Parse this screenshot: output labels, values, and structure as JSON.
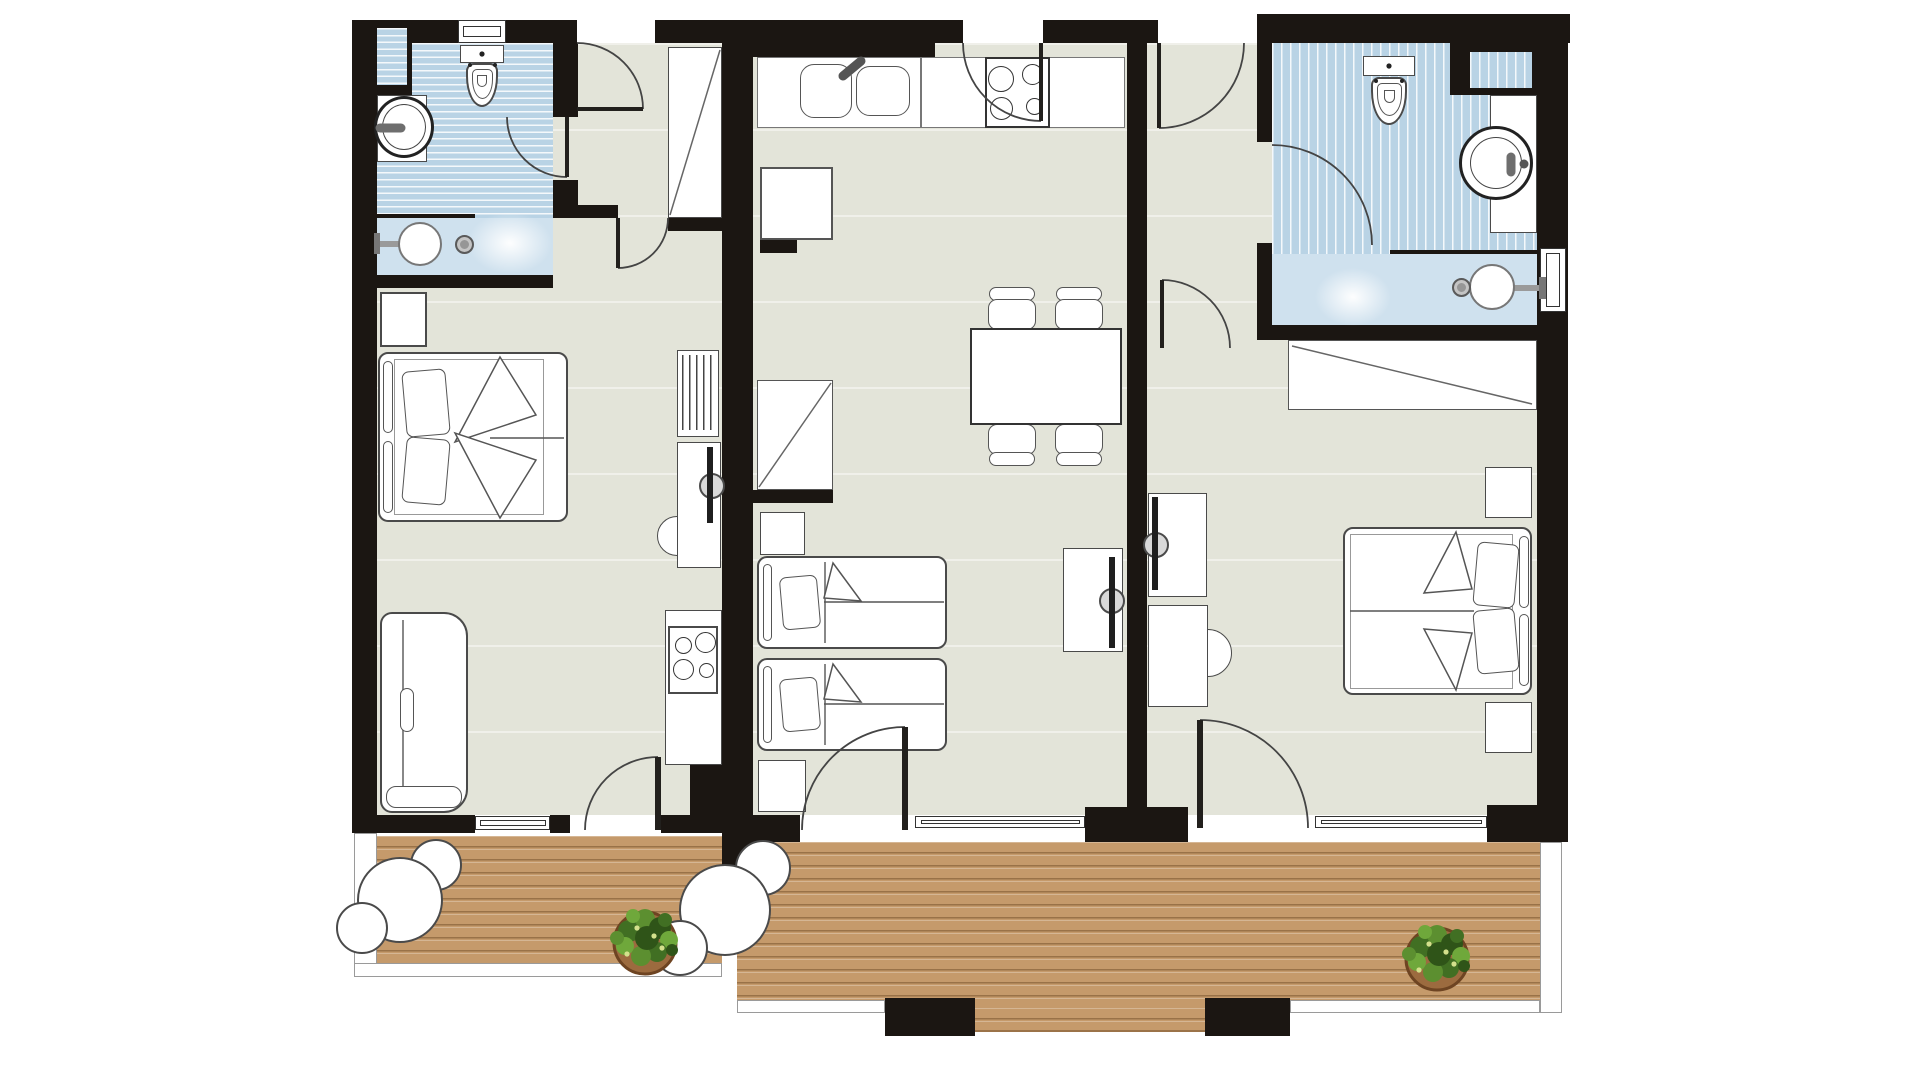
{
  "document": {
    "kind": "architectural-floor-plan",
    "visible_text": "none",
    "canvas": {
      "width": 1920,
      "height": 1080
    }
  },
  "palette": {
    "wall": "#1b1612",
    "floor": "#e3e4d9",
    "tile": "#b9d3e5",
    "shower": "#cfe1ee",
    "deck": "#c59a6b",
    "furnb": "#4a4a4a",
    "line": "#444444",
    "plant_green_dark": "#2f5418",
    "plant_green": "#416f23",
    "plant_green_mid": "#5c8f30",
    "plant_green_light": "#6fa83b",
    "pot": "#9c6b3f",
    "pot_border": "#6e4422"
  },
  "plan": {
    "units": [
      {
        "name": "left-studio",
        "rooms": [
          "bathroom",
          "entry-hall",
          "living-bedroom",
          "kitchenette",
          "balcony"
        ],
        "fixtures": [
          "toilet",
          "washbasin",
          "shower-head",
          "shower-control",
          "wall-niche",
          "entry-wardrobe",
          "double-bed",
          "nightstand",
          "sofa",
          "radiator",
          "desk-with-tv",
          "desk-chair",
          "stove",
          "balcony-table",
          "balcony-chairs",
          "potted-plant",
          "window",
          "doors"
        ]
      },
      {
        "name": "middle-apartment",
        "rooms": [
          "kitchen-living",
          "dining-area",
          "twin-bedroom",
          "balcony"
        ],
        "fixtures": [
          "kitchen-counter",
          "double-sink",
          "cooktop",
          "tall-cabinet",
          "dining-table",
          "four-chairs",
          "wardrobe",
          "nightstands",
          "single-bed",
          "single-bed",
          "tv-cabinet",
          "balcony-table",
          "balcony-chairs",
          "balcony-door",
          "window"
        ]
      },
      {
        "name": "right-apartment",
        "rooms": [
          "entry-hall",
          "bathroom",
          "bedroom",
          "balcony"
        ],
        "fixtures": [
          "toilet",
          "washbasin",
          "shower-head",
          "shower-control",
          "wall-niche",
          "built-in-wardrobe",
          "double-bed",
          "nightstands",
          "tv-cabinet",
          "desk",
          "desk-chair",
          "potted-plant",
          "balcony-door",
          "windows"
        ]
      }
    ]
  }
}
